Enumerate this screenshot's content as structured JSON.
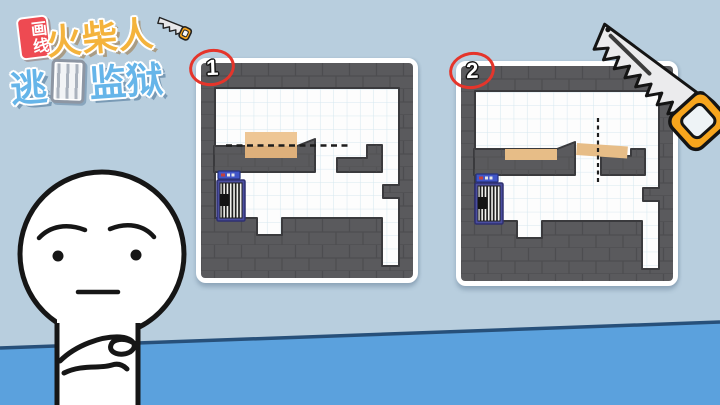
{
  "scene": {
    "sky_color": "#b8cede",
    "floor_color": "#5ba1dd",
    "floor_line_color": "#27507a"
  },
  "logo": {
    "badge_text": "画线",
    "title_text": "火柴人",
    "subtitle_prefix": "逃",
    "subtitle_suffix": "监狱"
  },
  "steps": [
    {
      "number": "1"
    },
    {
      "number": "2"
    }
  ],
  "colors": {
    "wall_gray": "#5a5a5d",
    "wood_tan": "#e9c28e",
    "door_frame_blue": "#4a4da0",
    "saw_handle_orange": "#f7a51d",
    "badge_red": "#e5352b"
  },
  "icons": {
    "saw": "hand-saw-icon",
    "cage": "jail-cage-icon",
    "door": "cell-door-icon",
    "cut_line": "dashed-cut-line"
  },
  "character": {
    "expression": "worried-thinking-stickman"
  }
}
